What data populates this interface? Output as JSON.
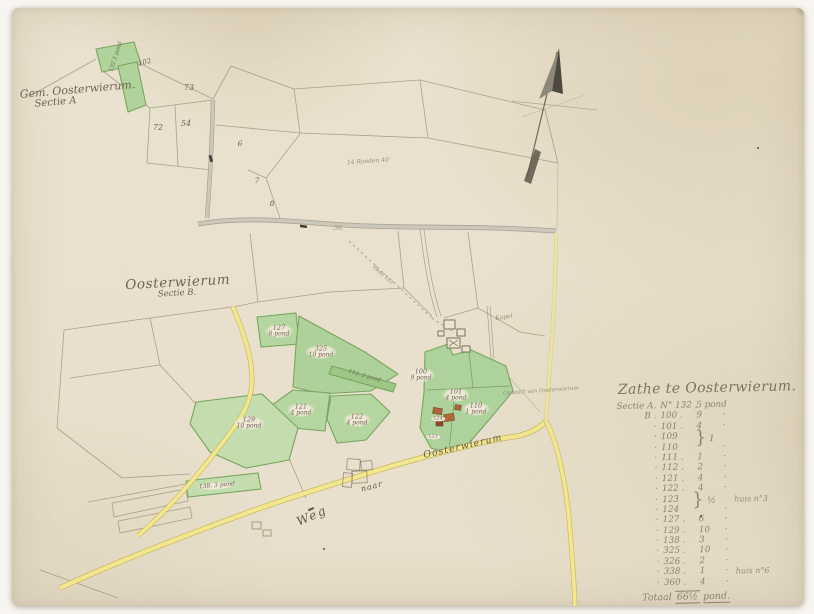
{
  "region_labels": {
    "gem_line1": "Gem. Oosterwierum.",
    "gem_line2": "Sectie A",
    "oost_line1": "Oosterwierum",
    "oost_line2": "Sectie B."
  },
  "road_labels": {
    "weg": "Weg",
    "naar": "naar",
    "oosterwierum": "Oosterwierum",
    "opvaart": "Opvaart van Oosterwierum"
  },
  "misc_labels": {
    "roeden": "14 Roeden 40",
    "n56": ".56.",
    "reed": "Reed 101",
    "kapel": "Kapel"
  },
  "parcel_numbers": [
    {
      "n": "102"
    },
    {
      "n": "73"
    },
    {
      "n": "72"
    },
    {
      "n": "54"
    },
    {
      "n": "6"
    },
    {
      "n": "7"
    },
    {
      "n": "8"
    },
    {
      "n": "124"
    },
    {
      "n": "123"
    }
  ],
  "parcels": {
    "p132": {
      "txt": "132  5 pond"
    },
    "p127": {
      "num": "127",
      "area": "6 pond"
    },
    "p325": {
      "num": "325",
      "area": "10 pond"
    },
    "p112": {
      "txt": "112. 2 pond"
    },
    "p121": {
      "num": "121",
      "area": "4 pond"
    },
    "p122": {
      "num": "122",
      "area": "4 pond"
    },
    "p100": {
      "num": "100",
      "area": "9 pond"
    },
    "p101": {
      "num": "101",
      "area": "4 pond"
    },
    "p110": {
      "num": "110",
      "area": "1 pond"
    },
    "p129": {
      "num": "129",
      "area": "10 pond"
    },
    "p138": {
      "txt": "138. 3 pond"
    }
  },
  "legend": {
    "title": "Zathe te Oosterwierum.",
    "rows": [
      {
        "c1": "Sectie A.",
        "c2": "N° 132 ,",
        "c3": "5 pond",
        "c4": ""
      },
      {
        "c1": "B  .",
        "c2": "100 .",
        "c3": "9",
        "c4": "·"
      },
      {
        "c1": "·",
        "c2": "101 .",
        "c3": "4",
        "c4": "·"
      },
      {
        "c1": "·",
        "c2": "109",
        "c3": "",
        "c4": ""
      },
      {
        "c1": "·",
        "c2": "110",
        "c3": "",
        "c4": "·"
      },
      {
        "c1": "·",
        "c2": "111 .",
        "c3": "1",
        "c4": "·"
      },
      {
        "c1": "·",
        "c2": "112 .",
        "c3": "2",
        "c4": "·"
      },
      {
        "c1": "·",
        "c2": "121 .",
        "c3": "4",
        "c4": "·"
      },
      {
        "c1": "·",
        "c2": "122 .",
        "c3": "4",
        "c4": "·"
      },
      {
        "c1": "·",
        "c2": "123",
        "c3": "",
        "c4": "",
        "note": "huis n°3"
      },
      {
        "c1": "·",
        "c2": "124",
        "c3": "",
        "c4": "·"
      },
      {
        "c1": "·",
        "c2": "127 .",
        "c3": "6",
        "c4": "·"
      },
      {
        "c1": "·",
        "c2": "129 .",
        "c3": "10",
        "c4": "·"
      },
      {
        "c1": "·",
        "c2": "138 .",
        "c3": "3",
        "c4": "·"
      },
      {
        "c1": "·",
        "c2": "325 .",
        "c3": "10",
        "c4": "·"
      },
      {
        "c1": "·",
        "c2": "326 .",
        "c3": "2",
        "c4": "·"
      },
      {
        "c1": "·",
        "c2": "338 .",
        "c3": "1",
        "c4": "·",
        "note": "huis n°6"
      },
      {
        "c1": "·",
        "c2": "360 .",
        "c3": "4",
        "c4": "·"
      }
    ],
    "braces": {
      "pair1": {
        "glyph": "}",
        "value": "1"
      },
      "pair2": {
        "glyph": "}",
        "value": "½"
      }
    },
    "total": {
      "label": "Totaal",
      "num": "66½",
      "unit": "pond."
    }
  },
  "colors": {
    "green_fill": "#b5d6a0",
    "green_edge": "#79a560",
    "yellow_road": "#f2e78e",
    "gray_road": "#ccc8b9",
    "ink": "#6e6453"
  }
}
